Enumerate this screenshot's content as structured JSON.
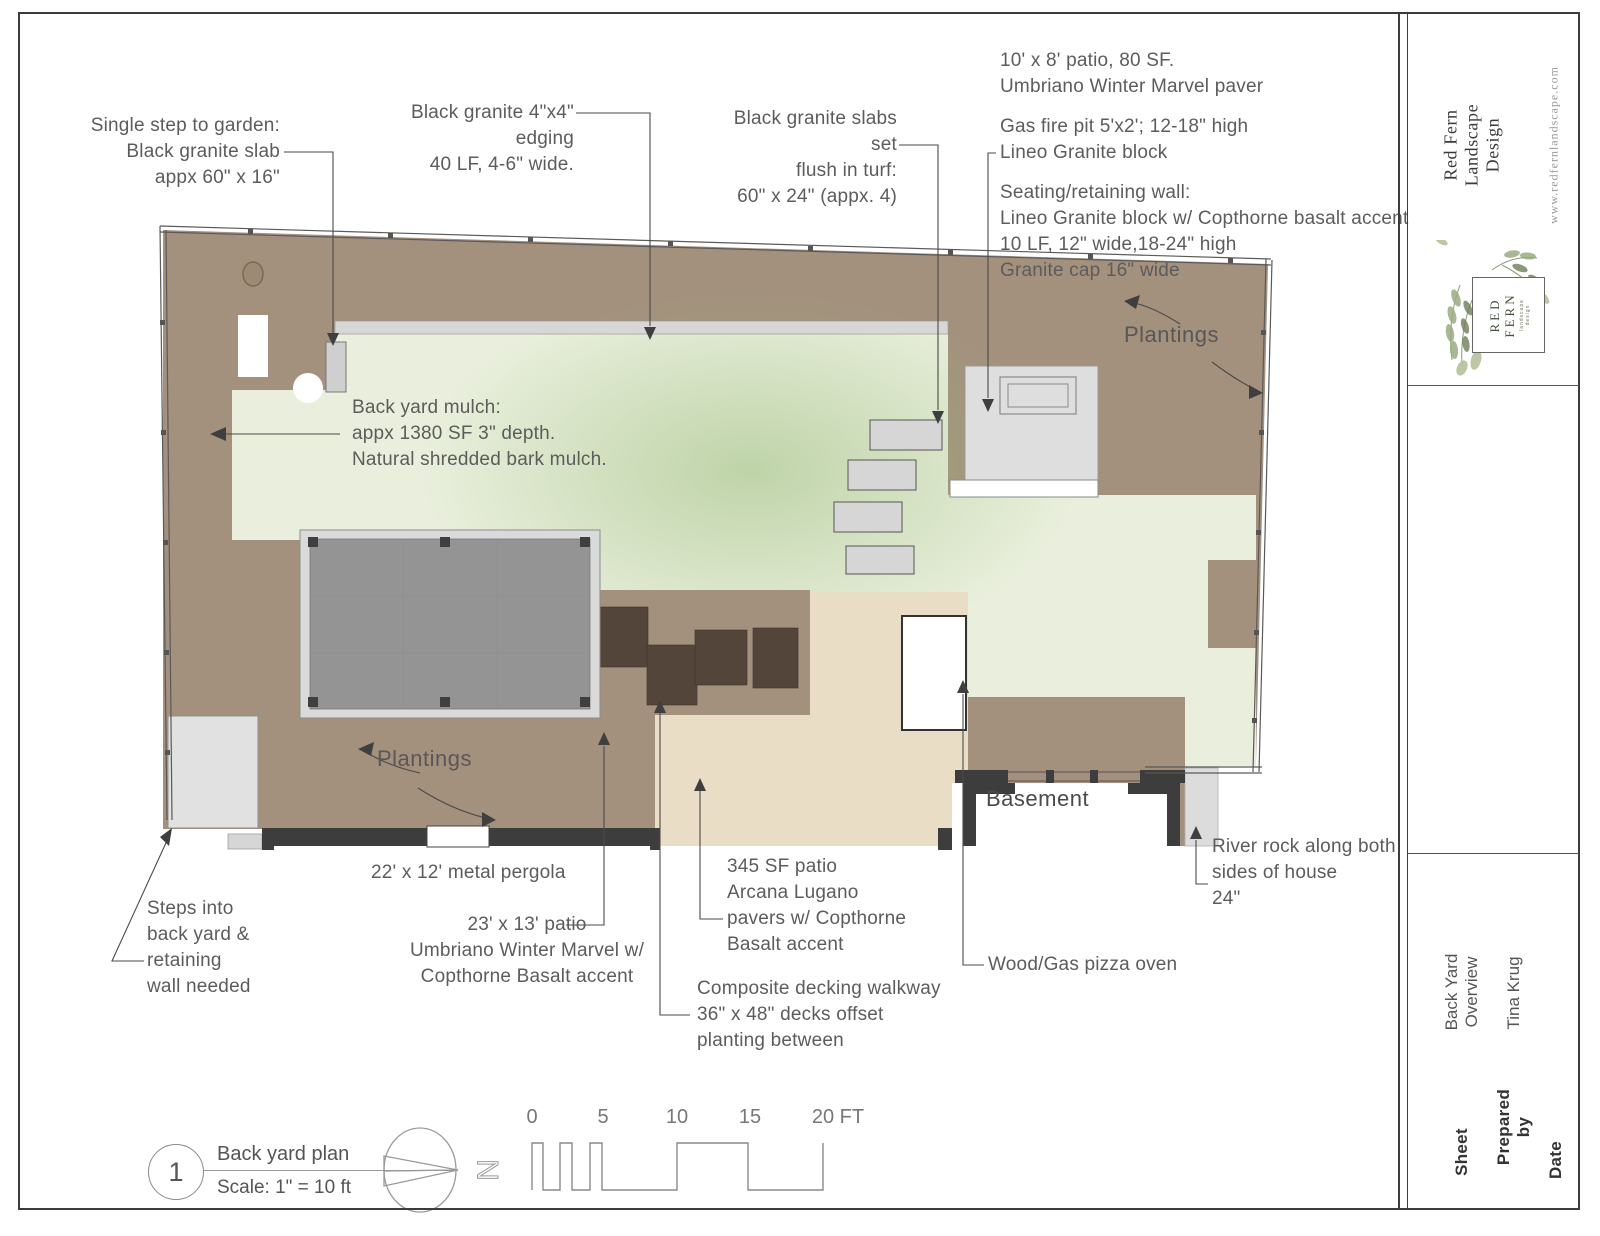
{
  "colors": {
    "mulch": "#a3907d",
    "turf": "#e9efdc",
    "turf_shade": "#9cbd7e",
    "hardscape": "#dedede",
    "patio_tan": "#e9ddc6",
    "deck_brown": "#54453a",
    "pergola_canopy": "#949494",
    "pergola_frame": "#dadada",
    "wall_dark": "#3d3d3d",
    "leader": "#4a4a4a",
    "text": "#5c5c5c"
  },
  "callouts": {
    "single_step": "Single step to garden:\nBlack granite slab\nappx 60\" x 16\"",
    "edging": "Black granite 4\"x4\" edging\n40 LF, 4-6\" wide.",
    "slabs": "Black granite slabs set\nflush in turf:\n60\" x 24\" (appx. 4)",
    "patio_80": "10' x 8' patio, 80 SF.\nUmbriano Winter Marvel paver",
    "fire_pit": "Gas fire pit 5'x2'; 12-18\" high\nLineo Granite block",
    "seating_wall": "Seating/retaining wall:\nLineo Granite block w/ Copthorne basalt accent\n10 LF, 12\" wide,18-24\" high\nGranite cap 16\" wide",
    "mulch": "Back yard mulch:\nappx 1380 SF 3\" depth.\nNatural shredded bark mulch.",
    "plantings_right": "Plantings",
    "plantings_left": "Plantings",
    "basement": "Basement",
    "river_rock": "River rock along both\nsides of house\n24\"",
    "steps": "Steps into\nback yard &\nretaining\nwall needed",
    "pergola": "22' x 12' metal pergola",
    "patio_23": "23' x 13' patio\nUmbriano Winter Marvel w/\nCopthorne Basalt accent",
    "patio_345": "345 SF patio\nArcana Lugano\npavers w/ Copthorne\nBasalt accent",
    "pizza_oven": "Wood/Gas pizza oven",
    "decking": "Composite decking walkway\n36\" x 48\" decks offset\nplanting between"
  },
  "footer": {
    "drawing_number": "1",
    "drawing_title": "Back yard plan",
    "drawing_scale": "Scale: 1\" = 10 ft",
    "north_letter": "N",
    "scale_ticks": [
      "0",
      "5",
      "10",
      "15",
      "20 FT"
    ]
  },
  "title_block": {
    "company": "Red Fern Landscape Design",
    "website": "www.redfernlandscape.com",
    "logo_name": "RED\nFERN",
    "logo_subtitle": "landscape design",
    "sheet_label": "Sheet",
    "sheet_value": "Back Yard\nOverview",
    "prepared_by_label": "Prepared by",
    "prepared_by_value": "Tina Krug",
    "date_label": "Date",
    "date_value": ""
  }
}
